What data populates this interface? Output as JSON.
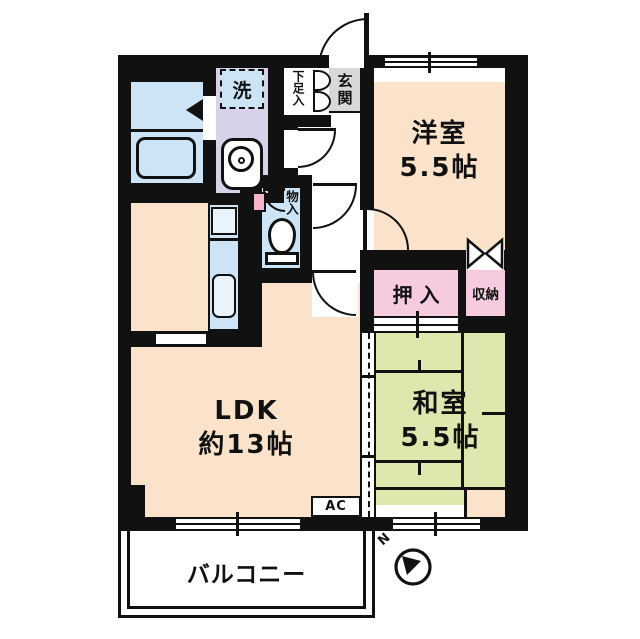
{
  "plan": {
    "compass_label": "N",
    "balcony_label": "バルコニー",
    "ac_label": "AC"
  },
  "rooms": {
    "western": {
      "name": "洋室",
      "size": "5.5帖"
    },
    "japanese": {
      "name": "和室",
      "size": "5.5帖"
    },
    "ldk": {
      "name": "LDK",
      "size": "約13帖"
    },
    "oshiire": {
      "name": "押入"
    },
    "shuunou": {
      "name": "収納"
    },
    "monoire": {
      "name": "物入"
    },
    "genkan": {
      "name": "玄関"
    },
    "getabako": {
      "name": "下足入"
    },
    "washer": {
      "name": "洗"
    }
  },
  "palette": {
    "room_peach": "#fbe3cb",
    "tatami_green": "#dee8ae",
    "closet_pink": "#f6cbdf",
    "washroom_lavender": "#d7d1e9",
    "water_blue": "#cde4f6",
    "entrance_gray": "#d8d8d8",
    "wall_black": "#111111"
  }
}
